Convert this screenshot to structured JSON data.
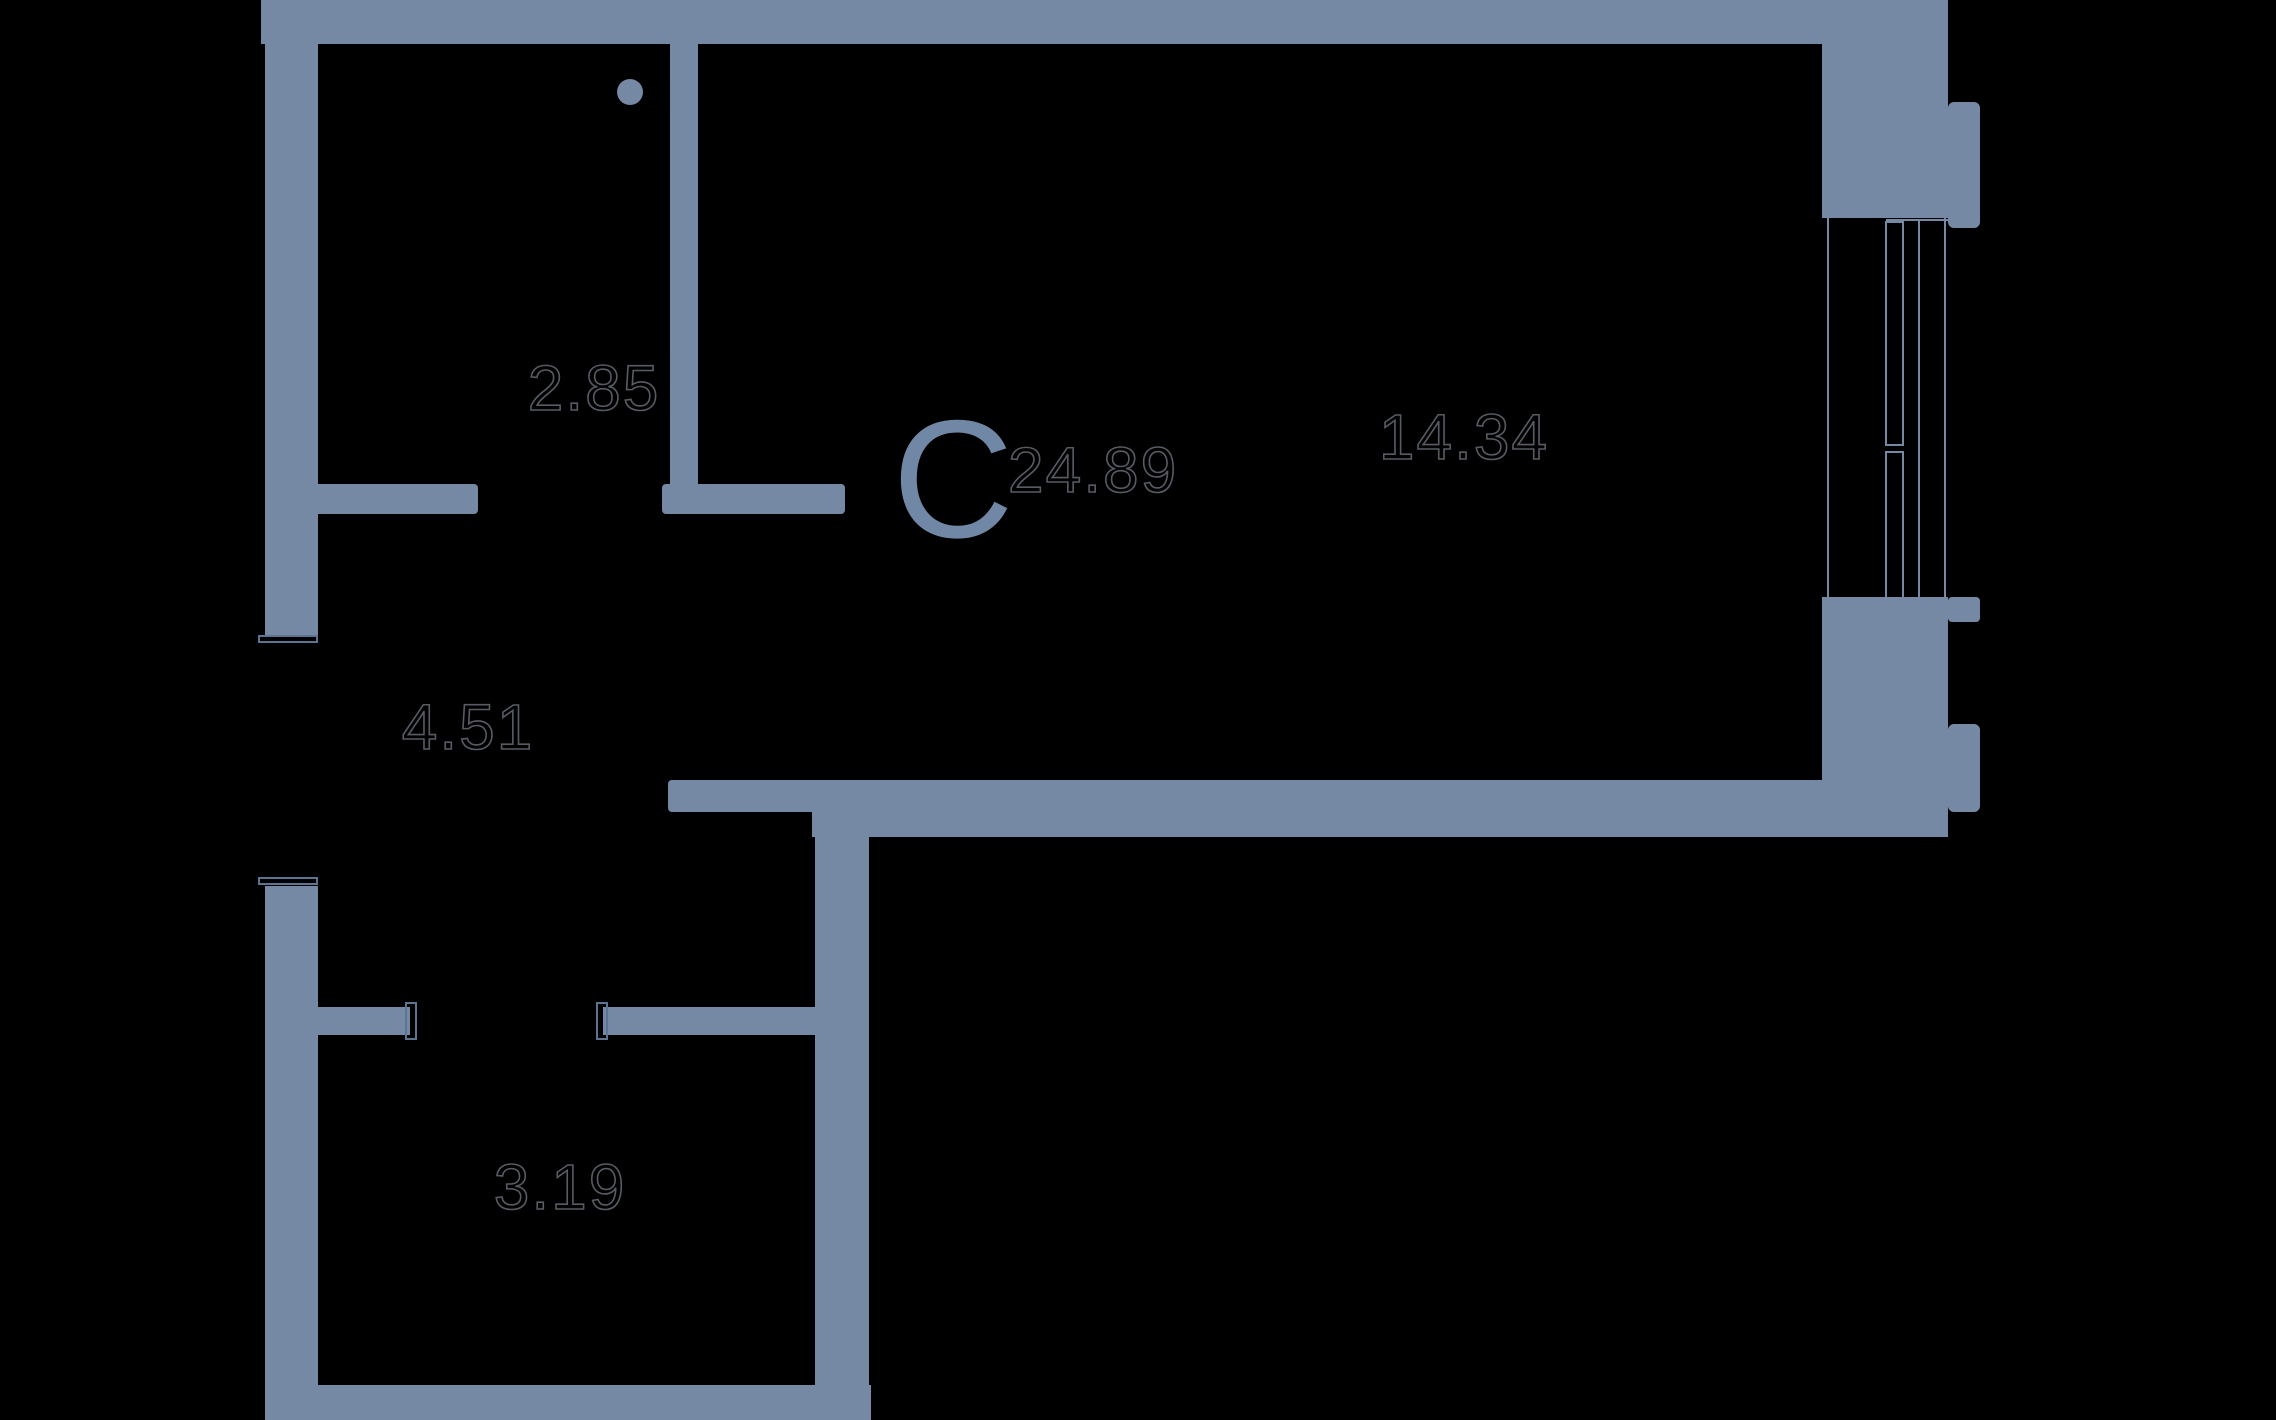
{
  "plan": {
    "title": "studio-apartment-floor-plan",
    "apartment_type_letter": "C",
    "total_area": "24.89",
    "rooms": [
      {
        "id": "kitchen-bath-room",
        "area": "2.85"
      },
      {
        "id": "living-room",
        "area": "14.34"
      },
      {
        "id": "hallway",
        "area": "4.51"
      },
      {
        "id": "bathroom",
        "area": "3.19"
      }
    ],
    "labels": {
      "type_letter": "C",
      "total": "24.89",
      "room_top_left": "2.85",
      "room_living": "14.34",
      "room_hall": "4.51",
      "room_bottom": "3.19"
    },
    "colors": {
      "bg": "#000000",
      "wall": "#7589A4",
      "letter": "#7187A6",
      "outline": "#575C64",
      "thin": "#5C7392"
    }
  }
}
